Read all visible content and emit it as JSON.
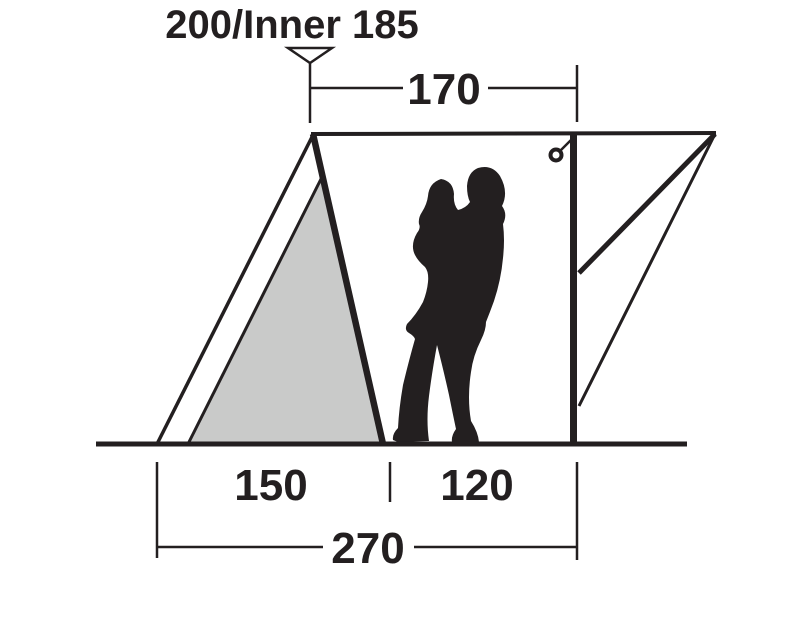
{
  "diagram": {
    "peak_height_label": "200/Inner 185",
    "dims": {
      "top_width": "170",
      "inner_base": "150",
      "porch_base": "120",
      "total_base": "270"
    }
  },
  "colors": {
    "line": "#231f20",
    "inner_fill": "#c9cac9",
    "background": "#ffffff"
  }
}
